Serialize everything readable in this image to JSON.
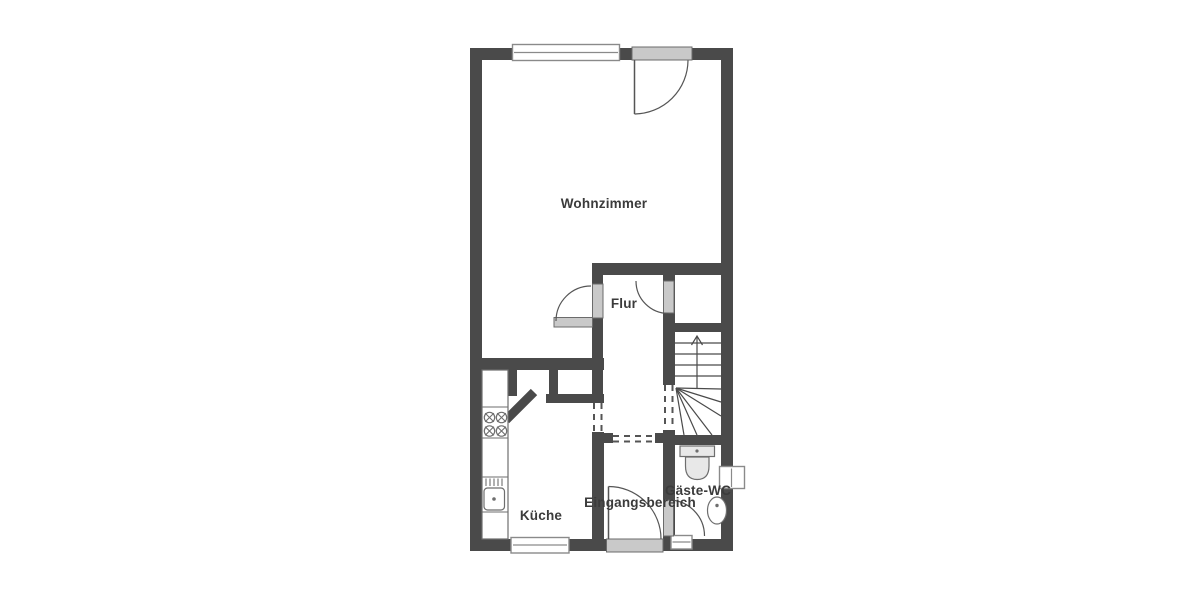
{
  "page": {
    "background": "#ffffff"
  },
  "floorplan": {
    "kind": "residential ground-floor plan",
    "rooms": [
      {
        "id": "wohnzimmer",
        "label": "Wohnzimmer"
      },
      {
        "id": "flur",
        "label": "Flur"
      },
      {
        "id": "kueche",
        "label": "Küche"
      },
      {
        "id": "eingangsbereich",
        "label": "Eingangsbereich"
      },
      {
        "id": "gaeste-wc",
        "label": "Gäste-WC"
      }
    ],
    "fixtures": [
      {
        "id": "stove",
        "icon": "stove-burners-icon",
        "room": "kueche"
      },
      {
        "id": "kitchen-sink",
        "icon": "kitchen-sink-icon",
        "room": "kueche"
      },
      {
        "id": "counter",
        "icon": "countertop-icon",
        "room": "kueche"
      },
      {
        "id": "toilet",
        "icon": "toilet-icon",
        "room": "gaeste-wc"
      },
      {
        "id": "washbasin",
        "icon": "washbasin-icon",
        "room": "gaeste-wc"
      },
      {
        "id": "stairs",
        "icon": "stairs-up-arrow-icon",
        "room": "flur"
      }
    ],
    "colors": {
      "wall": "#4a4a4a",
      "door-fill": "#c9c9c9",
      "door-stroke": "#6b6b6b",
      "window-stroke": "#8a8a8a",
      "line": "#555555",
      "fixture-fill": "#e8e8e8",
      "fixture-stroke": "#6e6e6e",
      "label": "#3b3b3b"
    }
  }
}
